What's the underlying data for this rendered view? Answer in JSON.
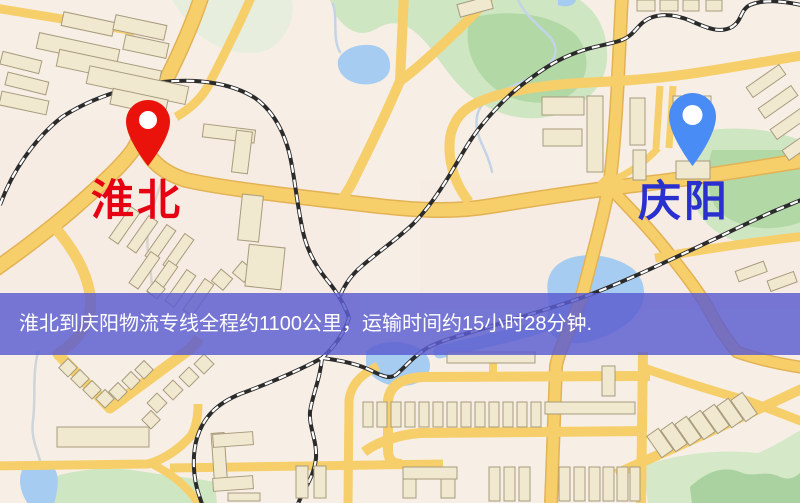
{
  "banner": {
    "text": "淮北到庆阳物流专线全程约1100公里，运输时间约15小时28分钟.",
    "bg_color": "#5b5dd0",
    "text_color": "#ffffff"
  },
  "markers": {
    "origin": {
      "label": "淮北",
      "label_color": "#e60012",
      "pin_color": "#e9130b",
      "pin_icon": "map-pin"
    },
    "destination": {
      "label": "庆阳",
      "label_color": "#2a2fd0",
      "pin_color": "#4a8cf5",
      "pin_icon": "map-pin"
    }
  },
  "map": {
    "type": "stylized-street-map",
    "road_color": "#f6cf6b",
    "park_color": "#cfe6c2",
    "water_color": "#a6cdf1",
    "building_color": "#f1e9cf",
    "railway_color": "#2b2b2b"
  }
}
